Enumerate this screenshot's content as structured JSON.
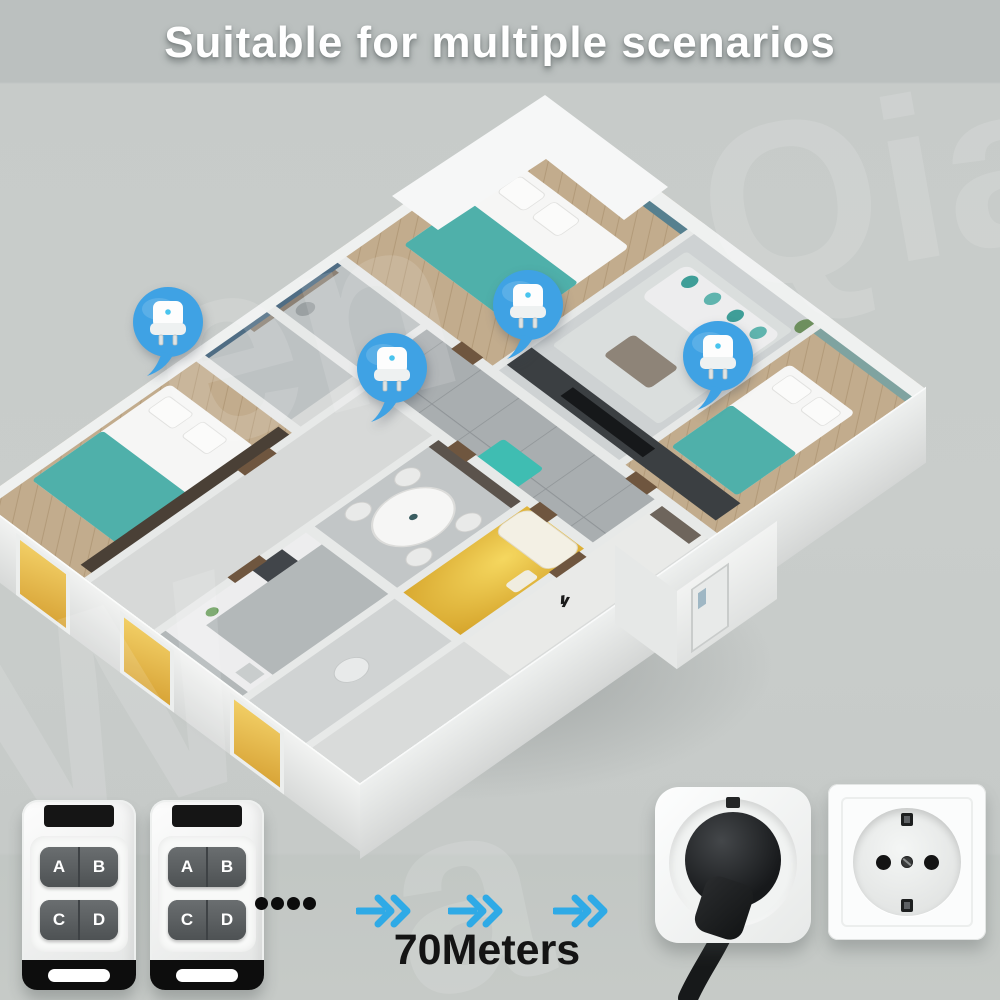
{
  "header": {
    "title": "Suitable for multiple scenarios"
  },
  "floorplan": {
    "pin_count": 4,
    "pin_icon": "smart-plug",
    "rooms_visible": [
      "master bedroom",
      "living room",
      "right bedroom",
      "study",
      "left bedroom",
      "dining room",
      "kitchen",
      "bathroom",
      "entry hall"
    ]
  },
  "remotes": {
    "count": 2,
    "buttons": [
      "A",
      "B",
      "C",
      "D"
    ]
  },
  "range": {
    "label": "70Meters",
    "dots": 4,
    "arrows": 3
  },
  "sockets": {
    "left": "smart-plug-with-power-plug",
    "right": "eu-wall-socket"
  },
  "watermark": {
    "fragments": [
      "W",
      "en",
      "a",
      "Qia"
    ]
  },
  "colors": {
    "pin_blue": "#3FA2E4",
    "arrow_blue": "#2FAAE6",
    "title_white": "#FFFFFF",
    "accent_teal": "#45AAA4",
    "bathroom_yellow": "#E8BE3C",
    "background_gray": "#C7CBC9"
  }
}
